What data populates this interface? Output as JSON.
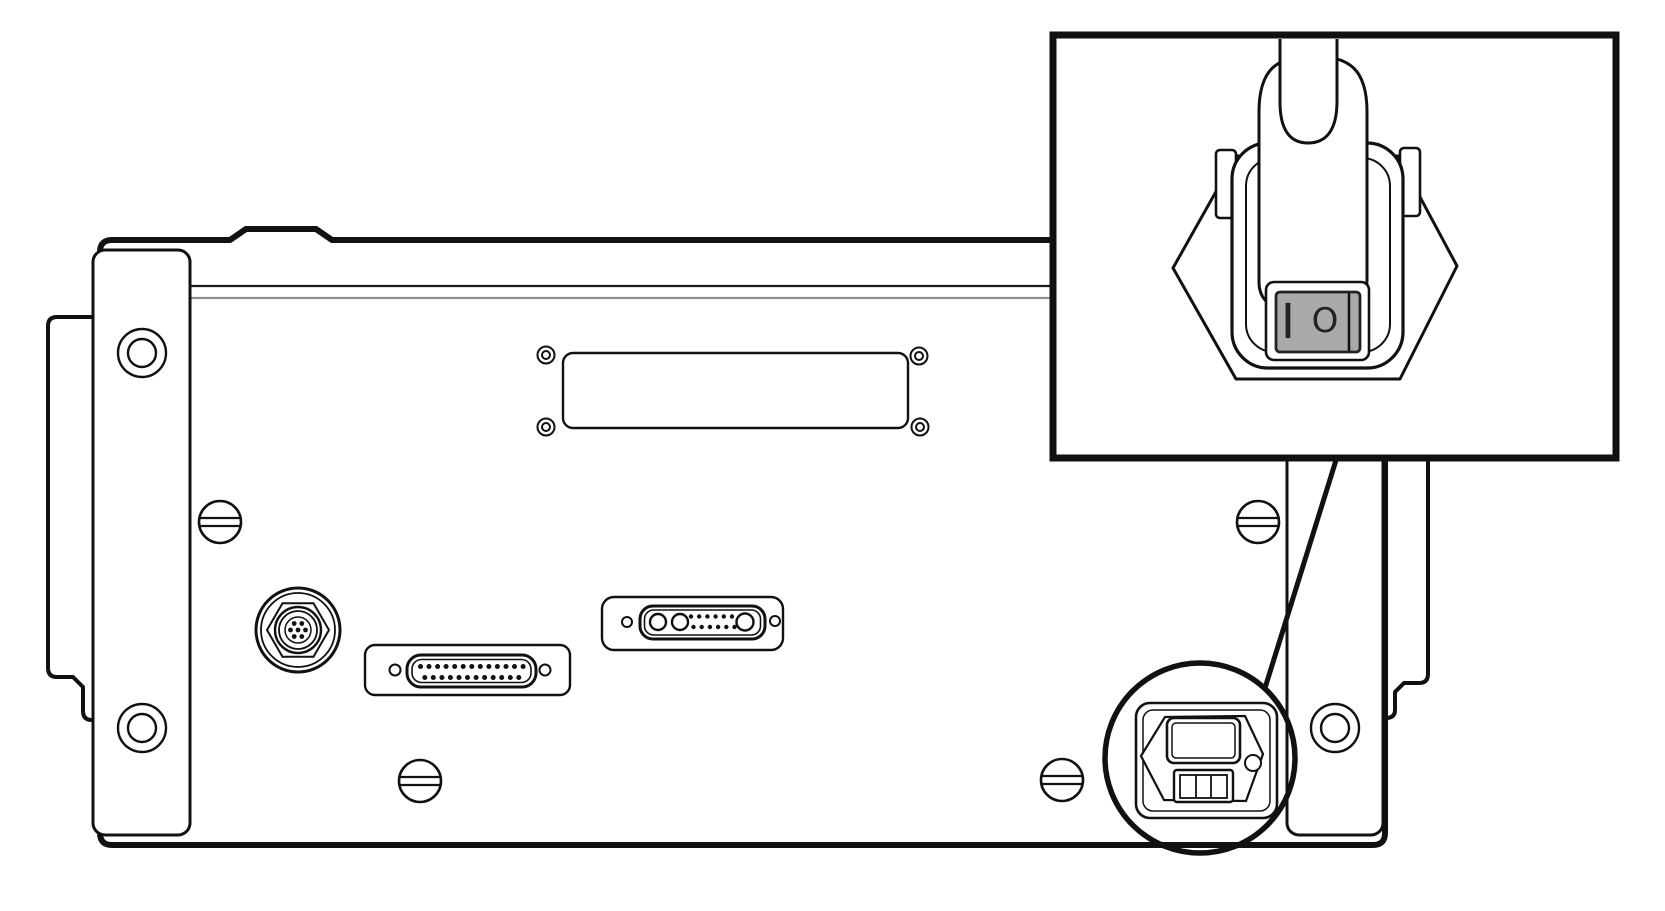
{
  "diagram": {
    "type": "technical-line-drawing",
    "subject": "Instrument rear panel with power-entry module and magnified power-cord / power-switch callout",
    "colors": {
      "line": "#111111",
      "fill": "#ffffff",
      "seam_highlight": "#909090",
      "rocker_gray": "#a9a9a9",
      "symbol": "#222222"
    },
    "inset": {
      "rocker_switch": {
        "on_label": "I",
        "off_label": "O"
      }
    },
    "components": {
      "rear_panel": "rear panel chassis",
      "left_bracket": "left rack-mount bracket with two holes",
      "right_bracket": "right rack-mount bracket with hole",
      "blank_plate": "blank cover plate with four corner screws",
      "panel_screws": "four slotted screws",
      "din_connector": "circular multi-pin connector",
      "db25_connector": "25-pin D-sub connector on plate",
      "combo_connector": "combo D-sub connector with 2+1 large contacts on plate",
      "power_module": "power entry module with IEC inlet and rocker switch",
      "callout_circle": "magnifier circle around power module",
      "inset_view": "enlarged view of power cord plugged into inlet above rocker switch"
    }
  }
}
